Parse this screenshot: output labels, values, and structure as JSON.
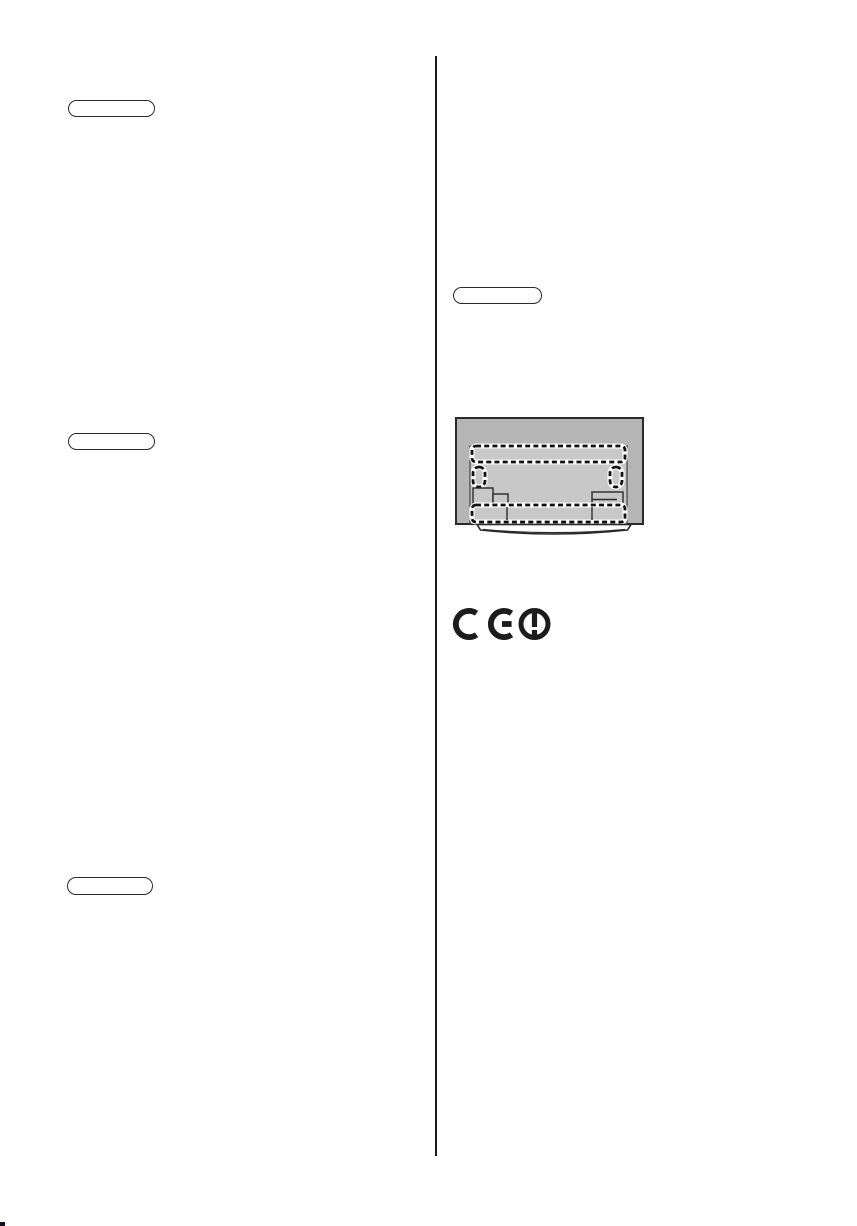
{
  "page": {
    "kind": "scanned manual page",
    "visible_text": ""
  },
  "colors": {
    "page-bg": "#ffffff",
    "ink": "#2a2a2a",
    "pill-border": "#2b2b2b",
    "divider": "#1c1c1c",
    "tv-outer-gray": "#b5b5b5",
    "tv-inner-gray": "#c8c8c8",
    "dash-ink": "#111111",
    "dash-gap": "#ffffff",
    "mark-ink": "#1c1c1c",
    "corner-mark": "#10102a"
  },
  "left_column": {
    "pills": [
      {
        "name": "section-heading-pill-1",
        "label": ""
      },
      {
        "name": "section-heading-pill-2",
        "label": ""
      },
      {
        "name": "section-heading-pill-3",
        "label": ""
      }
    ]
  },
  "right_column": {
    "pill": {
      "name": "section-heading-pill-4",
      "label": ""
    },
    "illustration": {
      "name": "tv-rear-panel-illustration",
      "elements": [
        "tv-back-cabinet",
        "recessed-connector-panel",
        "dashed-highlight-band-top",
        "dashed-slot-left",
        "dashed-slot-right",
        "terminal-step-block-left",
        "terminal-block-right",
        "dashed-highlight-band-bottom",
        "pedestal-stand"
      ]
    },
    "ce_mark": {
      "text": "CE",
      "icon": "alert-class2-circle-icon"
    }
  }
}
